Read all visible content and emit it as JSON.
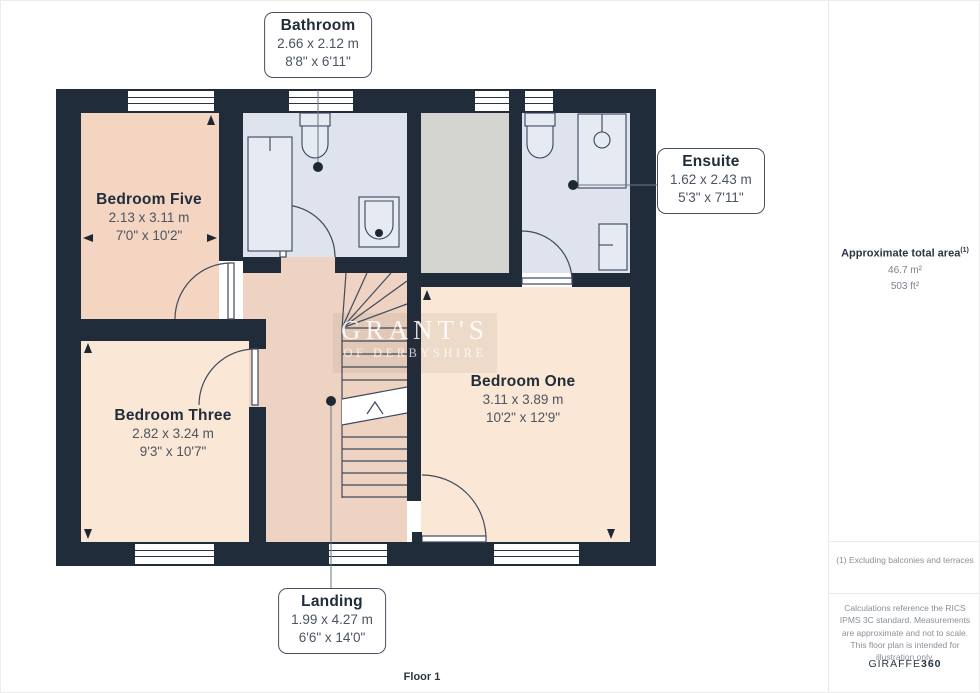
{
  "floorplan": {
    "floor_label": "Floor 1",
    "watermark": {
      "line1": "GRANT'S",
      "line2": "OF DERBYSHIRE"
    },
    "rooms": {
      "bathroom": {
        "name": "Bathroom",
        "metric": "2.66 x 2.12 m",
        "imperial": "8'8\" x 6'11\""
      },
      "ensuite": {
        "name": "Ensuite",
        "metric": "1.62 x 2.43 m",
        "imperial": "5'3\" x 7'11\""
      },
      "bedroom_five": {
        "name": "Bedroom Five",
        "metric": "2.13 x 3.11 m",
        "imperial": "7'0\" x 10'2\""
      },
      "bedroom_three": {
        "name": "Bedroom Three",
        "metric": "2.82 x 3.24 m",
        "imperial": "9'3\" x 10'7\""
      },
      "bedroom_one": {
        "name": "Bedroom One",
        "metric": "3.11 x 3.89 m",
        "imperial": "10'2\" x 12'9\""
      },
      "landing": {
        "name": "Landing",
        "metric": "1.99 x 4.27 m",
        "imperial": "6'6\" x 14'0\""
      }
    },
    "colors": {
      "wall": "#212c3a",
      "bedroom_fill": "#fbe7d5",
      "bedroom_five_fill": "#f3d5c1",
      "landing_fill": "#eed3c2",
      "wet_room_fill": "#dee3ee",
      "void_fill": "#d4d4d1"
    }
  },
  "sidebar": {
    "total_area": {
      "label": "Approximate total area",
      "footnote_marker": "(1)",
      "metric": "46.7 m²",
      "imperial": "503 ft²"
    },
    "footnote": "(1) Excluding balconies and terraces",
    "disclaimer": "Calculations reference the RICS IPMS 3C standard. Measurements are approximate and not to scale. This floor plan is intended for illustration only.",
    "brand": {
      "name": "GIRAFFE",
      "suffix": "360"
    }
  }
}
